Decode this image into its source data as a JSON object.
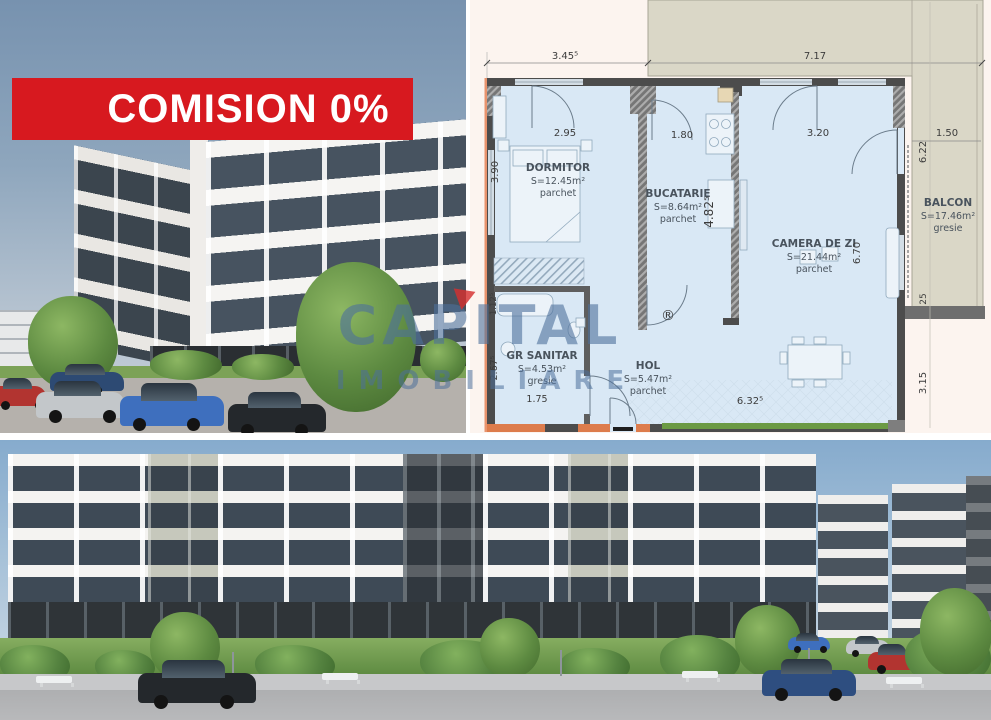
{
  "banner": {
    "label": "COMISION 0%",
    "bg": "#D7191F",
    "text_color": "#FFFFFF"
  },
  "watermark": {
    "line1": "CAPITAL",
    "line2": "IMOBILIARE",
    "color": "#4C6F9B",
    "accent": "#D43030"
  },
  "floorplan": {
    "rooms": [
      {
        "name": "DORMITOR",
        "area": "S=12.45m²",
        "floor": "parchet"
      },
      {
        "name": "BUCATARIE",
        "area": "S=8.64m²",
        "floor": "parchet"
      },
      {
        "name": "CAMERA DE ZI",
        "area": "S=21.44m²",
        "floor": "parchet"
      },
      {
        "name": "GR SANITAR",
        "area": "S=4.53m²",
        "floor": "gresie"
      },
      {
        "name": "HOL",
        "area": "S=5.47m²",
        "floor": "parchet"
      },
      {
        "name": "BALCON",
        "area": "S=17.46m²",
        "floor": "gresie"
      }
    ],
    "dims": {
      "top_left": "3.45⁵",
      "top_right": "7.17",
      "dormitor_w": "2.95",
      "bucatarie_w": "1.80",
      "camera_w": "3.20",
      "dormitor_h": "3.90",
      "shaft_h": "4.82⁵",
      "camera_h": "6.70",
      "sanitar_small": "1.12⁵",
      "sanitar_h": "2.67⁵",
      "sanitar_w": "1.75",
      "hol_w": "6.32⁵",
      "balcon_h": "6.22",
      "balcon_w": "1.50",
      "right_small": "25",
      "right_low": "3.15"
    },
    "registered": "®"
  }
}
